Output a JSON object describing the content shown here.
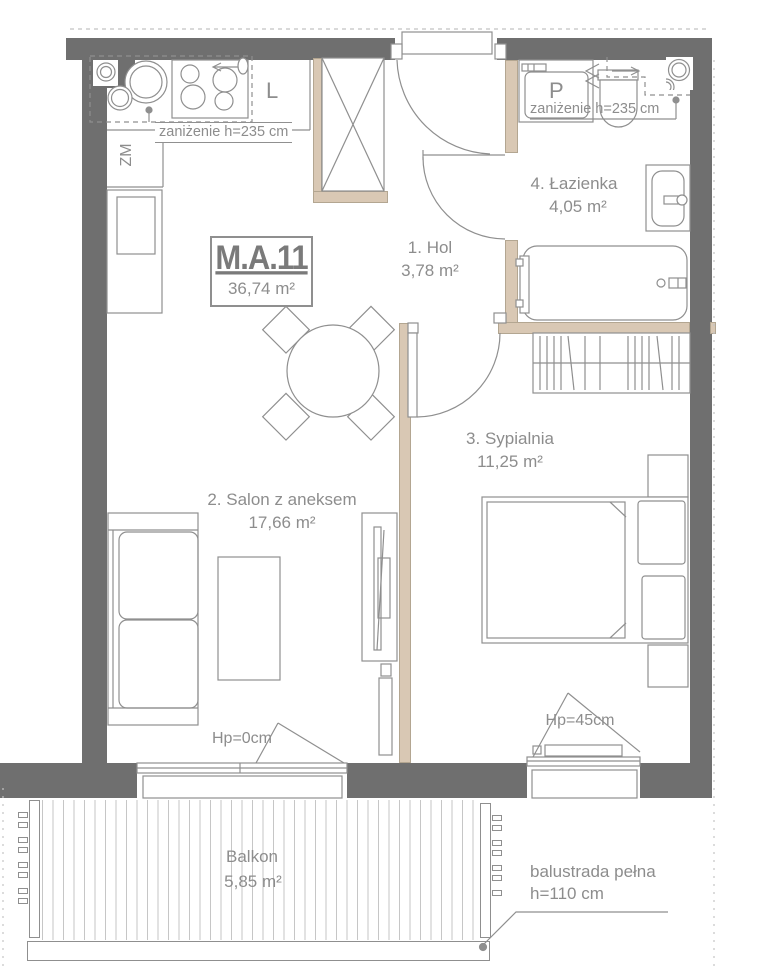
{
  "plan": {
    "unit": {
      "id": "M.A.11",
      "area": "36,74 m²"
    },
    "rooms": [
      {
        "name": "1. Hol",
        "area": "3,78 m²"
      },
      {
        "name": "2. Salon z aneksem",
        "area": "17,66 m²"
      },
      {
        "name": "3. Sypialnia",
        "area": "11,25 m²"
      },
      {
        "name": "4. Łazienka",
        "area": "4,05 m²"
      },
      {
        "name": "Balkon",
        "area": "5,85 m²"
      }
    ],
    "labels": {
      "kitchen_lowered_ceiling": "zaniżenie h=235 cm",
      "bathroom_lowered_ceiling": "zaniżenie h=235 cm",
      "salon_window_sill": "Hp=0cm",
      "bedroom_window_sill": "Hp=45cm",
      "balustrade": "balustrada pełna",
      "balustrade_height": "h=110 cm",
      "dishwasher": "ZM",
      "fridge": "L",
      "washer": "P"
    },
    "colors": {
      "wall": "#6f6f6f",
      "partition": "#d9c8b4",
      "line": "#8f8f8f",
      "text": "#8d8d8d"
    }
  }
}
